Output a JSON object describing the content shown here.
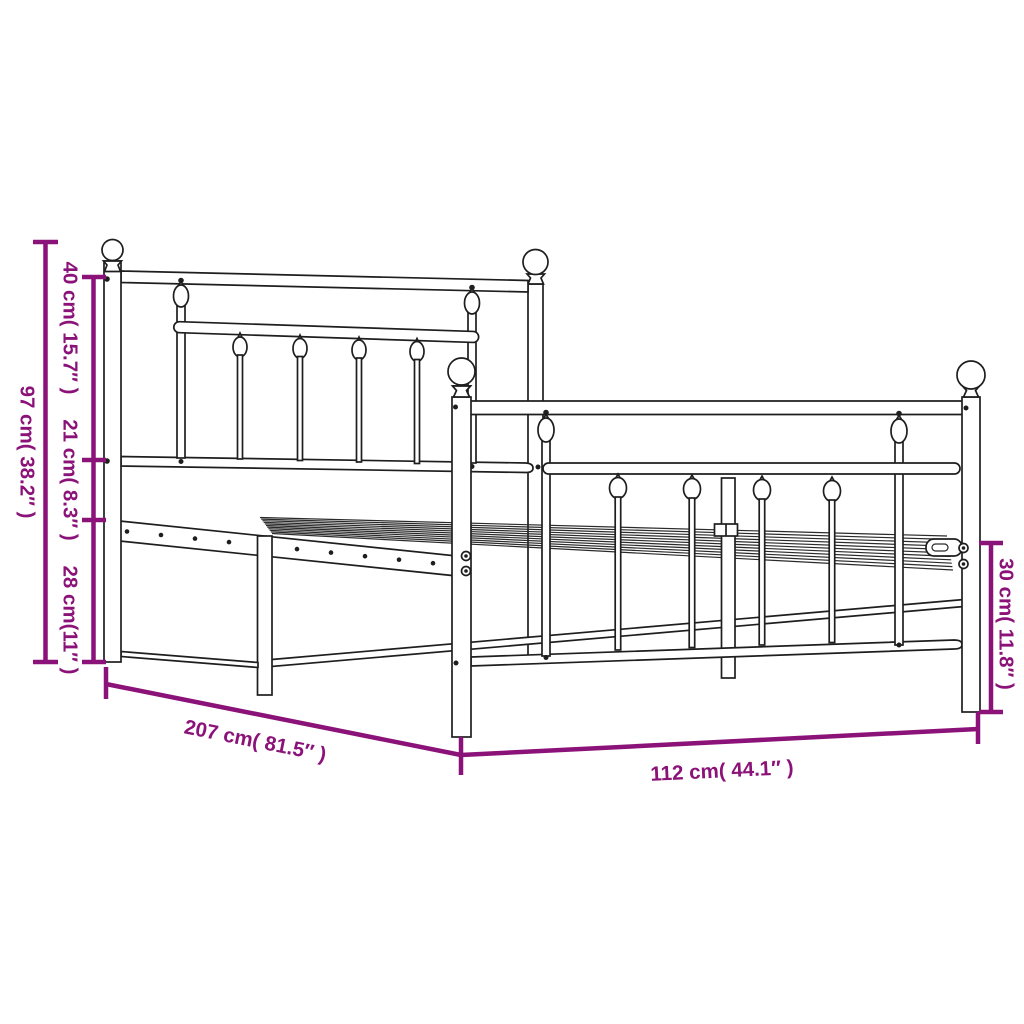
{
  "figure": {
    "type": "product-dimension-diagram",
    "subject": "metal bed frame with headboard and footboard",
    "background_color": "#ffffff",
    "line_color": "#1e1e1e",
    "dimension_color": "#8b1278",
    "labels": {
      "overall_height": "97 cm( 38.2″ )",
      "headboard_upper_section": "40 cm( 15.7″ )",
      "headboard_lower_section": "21 cm( 8.3″ )",
      "under_bed_clearance": "28 cm(11″ )",
      "bed_length": "207 cm( 81.5″ )",
      "bed_width": "112 cm( 44.1″ )",
      "footboard_height": "30 cm( 11.8″ )"
    }
  }
}
